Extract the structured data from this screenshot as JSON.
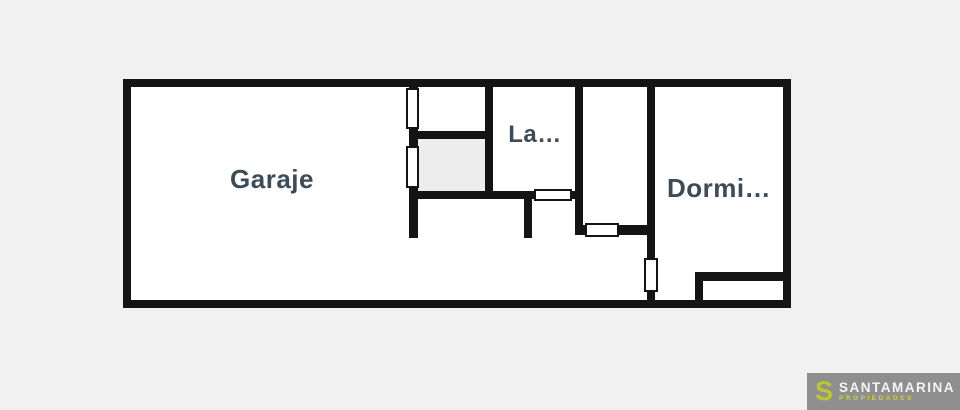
{
  "page": {
    "type": "real-estate-floor-plan",
    "background_color": "#f1f1f1"
  },
  "floorplan": {
    "wall_color": "#141414",
    "interior_color": "#ffffff",
    "shaded_room_color": "#ededed",
    "label_color": "#3d4a58",
    "rooms": [
      {
        "id": "garaje",
        "label": "Garaje"
      },
      {
        "id": "lavadero-truncated",
        "label": "La…"
      },
      {
        "id": "dormitorio-truncated",
        "label": "Dormi…"
      }
    ]
  },
  "watermark": {
    "background_color": "#8f8f8f",
    "logo_letter": "S",
    "brand": "SANTAMARINA",
    "tagline": "PROPIEDADES",
    "brand_color": "#f4f4f4",
    "accent_color": "#b9c82e"
  }
}
